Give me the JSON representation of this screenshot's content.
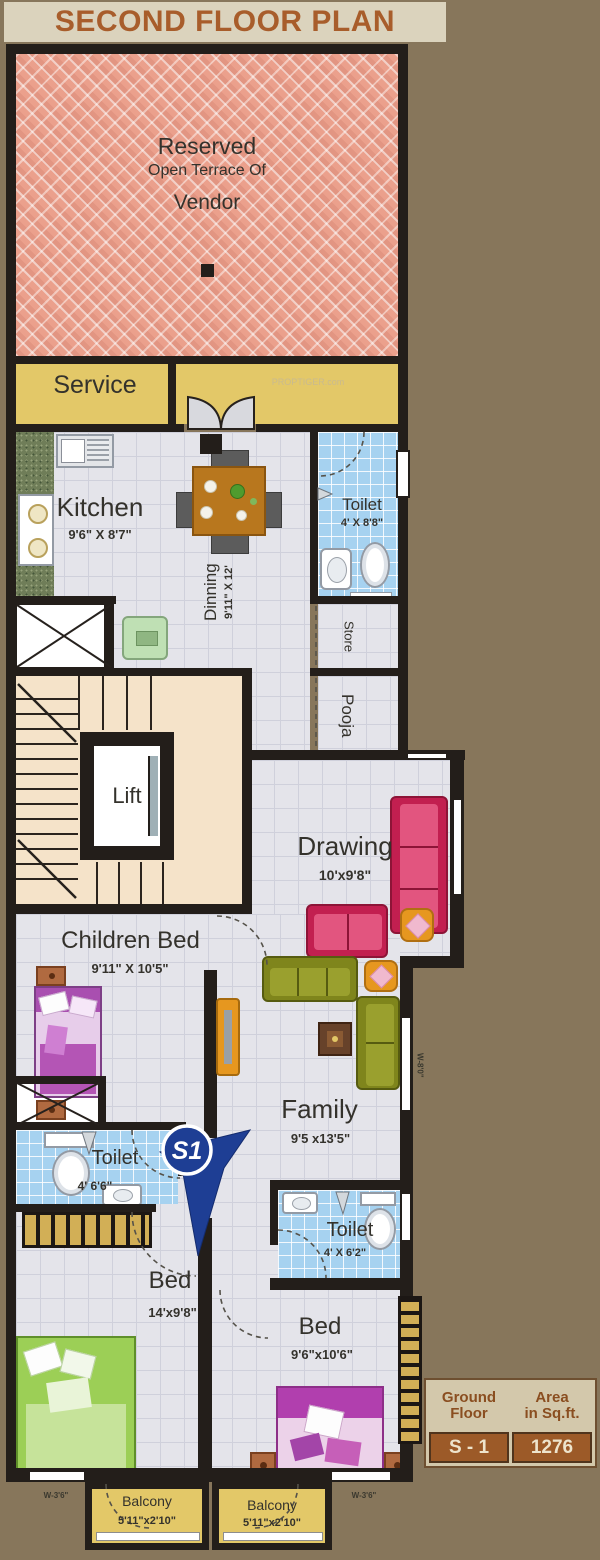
{
  "title": "SECOND FLOOR PLAN",
  "watermark": "PROPTIGER.com",
  "terrace": {
    "l1": "Reserved",
    "l2": "Open Terrace Of",
    "l3": "Vendor"
  },
  "labels": {
    "service": "Service",
    "kitchen": "Kitchen",
    "kitchen_dims": "9'6\" X 8'7\"",
    "dinning": "Dinning",
    "dinning_dims": "9'11\" X 12'",
    "toilet_top": "Toilet",
    "toilet_top_dims": "4' X 8'8\"",
    "store": "Store",
    "pooja": "Pooja",
    "lift": "Lift",
    "drawing": "Drawing",
    "drawing_dims": "10'x9'8\"",
    "children_bed": "Children Bed",
    "children_bed_dims": "9'11\" X 10'5\"",
    "family": "Family",
    "family_dims": "9'5 x13'5\"",
    "toilet_left": "Toilet",
    "toilet_left_dims": "4' 6'6\"",
    "toilet_right": "Toilet",
    "toilet_right_dims": "4' X 6'2\"",
    "bed_left": "Bed",
    "bed_left_dims": "14'x9'8\"",
    "bed_right": "Bed",
    "bed_right_dims": "9'6\"x10'6\"",
    "balcony_left": "Balcony",
    "balcony_left_dims": "5'11\"x2'10\"",
    "balcony_right": "Balcony",
    "balcony_right_dims": "5'11\"x2'10\"",
    "window_left": "W-3'6\"",
    "window_right": "W-3'6\"",
    "window_family": "W-8'0\""
  },
  "marker": {
    "label": "S1"
  },
  "summary": {
    "h1a": "Ground",
    "h1b": "Floor",
    "h2a": "Area",
    "h2b": "in Sq.ft.",
    "v1": "S - 1",
    "v2": "1276"
  },
  "colors": {
    "wall": "#231e1a",
    "terrace_brick": "#eba08c",
    "service_yellow": "#e3c868",
    "floor": "#e4e4ea",
    "toilet_tile": "#a6d2f0",
    "stair_cream": "#f5e3c9",
    "marker_blue": "#1e3e94",
    "title_brown": "#a85d2b",
    "table_value_bg": "#9c5a28"
  }
}
